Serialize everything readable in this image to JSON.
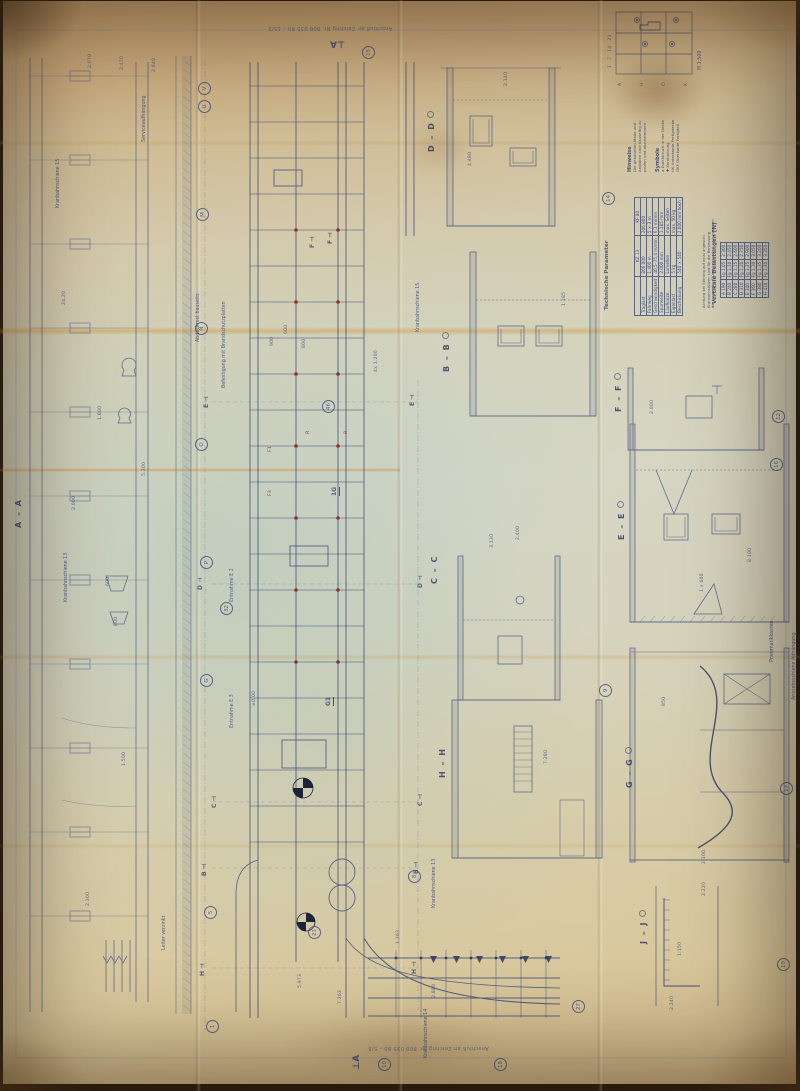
{
  "ink": "#44537c",
  "red": "#8e231a",
  "notes": {
    "top": "Anschluß an Zeichng Nr. 800 035 80 – 15/2",
    "bottom": "Anschluß an Zeichng Nr. 800 035 80 – 5/8"
  },
  "sections": [
    {
      "t": "A – A",
      "x": 14,
      "y": 528
    },
    {
      "t": "D – D",
      "x": 427,
      "y": 152,
      "cls": "wc"
    },
    {
      "t": "B – B",
      "x": 442,
      "y": 372,
      "cls": "wc"
    },
    {
      "t": "C – C",
      "x": 430,
      "y": 584
    },
    {
      "t": "H – H",
      "x": 438,
      "y": 778
    },
    {
      "t": "F – F",
      "x": 614,
      "y": 412,
      "cls": "wc"
    },
    {
      "t": "E – E",
      "x": 617,
      "y": 540,
      "cls": "wc"
    },
    {
      "t": "G – G",
      "x": 625,
      "y": 788,
      "cls": "wc"
    },
    {
      "t": "J – J",
      "x": 639,
      "y": 944,
      "cls": "wc"
    }
  ],
  "cut_marks": [
    {
      "t": "⊥A",
      "x": 330,
      "y": 38,
      "cls": "r180 big"
    },
    {
      "t": "⊥A",
      "x": 352,
      "y": 1070,
      "cls": "big"
    },
    {
      "t": "F ⊣",
      "x": 310,
      "y": 248
    },
    {
      "t": "F ⊣",
      "x": 328,
      "y": 244
    },
    {
      "t": "E ⊣",
      "x": 204,
      "y": 408
    },
    {
      "t": "E ⊣",
      "x": 410,
      "y": 406
    },
    {
      "t": "D ⊣",
      "x": 198,
      "y": 590
    },
    {
      "t": "D ⊣",
      "x": 418,
      "y": 588
    },
    {
      "t": "C ⊣",
      "x": 212,
      "y": 808
    },
    {
      "t": "C ⊣",
      "x": 418,
      "y": 806
    },
    {
      "t": "B ⊣",
      "x": 202,
      "y": 876
    },
    {
      "t": "B ⊣",
      "x": 414,
      "y": 874
    },
    {
      "t": "H ⊣",
      "x": 200,
      "y": 976
    },
    {
      "t": "H ⊣",
      "x": 412,
      "y": 974
    },
    {
      "t": "1G",
      "x": 332,
      "y": 496,
      "cls": "ul"
    },
    {
      "t": "G1",
      "x": 326,
      "y": 706,
      "cls": "ul"
    }
  ],
  "bubbles": [
    {
      "t": "V",
      "x": 198,
      "y": 82
    },
    {
      "t": "U",
      "x": 198,
      "y": 100
    },
    {
      "t": "M",
      "x": 196,
      "y": 208
    },
    {
      "t": "N",
      "x": 195,
      "y": 322
    },
    {
      "t": "O",
      "x": 195,
      "y": 438
    },
    {
      "t": "P",
      "x": 200,
      "y": 556
    },
    {
      "t": "G",
      "x": 200,
      "y": 674
    },
    {
      "t": "32",
      "x": 220,
      "y": 602
    },
    {
      "t": "46",
      "x": 322,
      "y": 400
    },
    {
      "t": "15",
      "x": 362,
      "y": 46
    },
    {
      "t": "21",
      "x": 308,
      "y": 926
    },
    {
      "t": "5",
      "x": 204,
      "y": 906
    },
    {
      "t": "1",
      "x": 206,
      "y": 1020
    },
    {
      "t": "8",
      "x": 408,
      "y": 870
    },
    {
      "t": "10",
      "x": 378,
      "y": 1058
    },
    {
      "t": "18",
      "x": 494,
      "y": 1058
    },
    {
      "t": "14",
      "x": 602,
      "y": 192
    },
    {
      "t": "12",
      "x": 772,
      "y": 410
    },
    {
      "t": "16",
      "x": 770,
      "y": 458
    },
    {
      "t": "9",
      "x": 599,
      "y": 684
    },
    {
      "t": "17",
      "x": 780,
      "y": 782
    },
    {
      "t": "19",
      "x": 777,
      "y": 958
    },
    {
      "t": "27",
      "x": 572,
      "y": 1000
    }
  ],
  "dims": [
    {
      "t": "2.070",
      "x": 88,
      "y": 68
    },
    {
      "t": "2.470",
      "x": 120,
      "y": 70
    },
    {
      "t": "2.640",
      "x": 152,
      "y": 72
    },
    {
      "t": "24,20",
      "x": 62,
      "y": 305
    },
    {
      "t": "1.800",
      "x": 98,
      "y": 420
    },
    {
      "t": "2.000",
      "x": 72,
      "y": 510
    },
    {
      "t": "5.300",
      "x": 142,
      "y": 476
    },
    {
      "t": "600",
      "x": 106,
      "y": 586
    },
    {
      "t": "800",
      "x": 114,
      "y": 626
    },
    {
      "t": "1.500",
      "x": 122,
      "y": 766
    },
    {
      "t": "2.300",
      "x": 86,
      "y": 906
    },
    {
      "t": "600",
      "x": 284,
      "y": 334
    },
    {
      "t": "900",
      "x": 270,
      "y": 346
    },
    {
      "t": "800",
      "x": 302,
      "y": 348
    },
    {
      "t": "4x 1.200",
      "x": 374,
      "y": 372
    },
    {
      "t": "±0,00",
      "x": 252,
      "y": 706
    },
    {
      "t": "5.973",
      "x": 298,
      "y": 988
    },
    {
      "t": "7.262",
      "x": 338,
      "y": 1004
    },
    {
      "t": "2.880",
      "x": 432,
      "y": 998
    },
    {
      "t": "1.363",
      "x": 396,
      "y": 944
    },
    {
      "t": "2.140",
      "x": 504,
      "y": 86
    },
    {
      "t": "4.480",
      "x": 468,
      "y": 166
    },
    {
      "t": "2.400",
      "x": 516,
      "y": 540
    },
    {
      "t": "3.130",
      "x": 490,
      "y": 548
    },
    {
      "t": "7.280",
      "x": 544,
      "y": 764
    },
    {
      "t": "1.185",
      "x": 562,
      "y": 306
    },
    {
      "t": "2.000",
      "x": 650,
      "y": 414
    },
    {
      "t": "1 x 600",
      "x": 700,
      "y": 592
    },
    {
      "t": "8.100",
      "x": 748,
      "y": 562
    },
    {
      "t": "850",
      "x": 662,
      "y": 706
    },
    {
      "t": "2.100",
      "x": 702,
      "y": 864
    },
    {
      "t": "2.220",
      "x": 702,
      "y": 896
    },
    {
      "t": "2.240",
      "x": 670,
      "y": 1010
    },
    {
      "t": "1:150",
      "x": 678,
      "y": 956
    }
  ],
  "annotations": [
    {
      "t": "Kranbahnschiene 15",
      "x": 56,
      "y": 208
    },
    {
      "t": "Serviceaufhängung",
      "x": 142,
      "y": 142
    },
    {
      "t": "Kranbahnschiene 13",
      "x": 64,
      "y": 602
    },
    {
      "t": "Kranbahnschiene 15.",
      "x": 416,
      "y": 332
    },
    {
      "t": "Kranbahnschiene 13",
      "x": 432,
      "y": 908
    },
    {
      "t": "Entnahme E 2",
      "x": 230,
      "y": 602
    },
    {
      "t": "Entnahme E 3",
      "x": 230,
      "y": 728
    },
    {
      "t": "Abdeckrost bauseits",
      "x": 196,
      "y": 342
    },
    {
      "t": "Befestigung mit Brandschutzplatten",
      "x": 222,
      "y": 388
    },
    {
      "t": "Leiter verzinkt",
      "x": 162,
      "y": 950
    },
    {
      "t": "Pneumatikkasten",
      "x": 770,
      "y": 662
    },
    {
      "t": "Antriebsschiene Abhängung",
      "x": 792,
      "y": 700
    },
    {
      "t": "Kranbahnschiene 14",
      "x": 424,
      "y": 1058
    },
    {
      "t": "M 1:500",
      "x": 698,
      "y": 70
    }
  ],
  "red_marks": [
    {
      "t": "R",
      "x": 306,
      "y": 434
    },
    {
      "t": "R",
      "x": 344,
      "y": 434
    },
    {
      "t": "F1",
      "x": 268,
      "y": 452
    },
    {
      "t": "F3",
      "x": 268,
      "y": 496
    }
  ],
  "key_plan": {
    "numbers": "1   7   14   21",
    "letters": [
      {
        "t": "A",
        "x": 618,
        "y": 86
      },
      {
        "t": "H",
        "x": 640,
        "y": 86
      },
      {
        "t": "O",
        "x": 662,
        "y": 86
      },
      {
        "t": "K",
        "x": 684,
        "y": 86
      }
    ]
  },
  "legend": {
    "hinweise": {
      "title": "Hinweise",
      "lines": [
        "Die genannten Maße und",
        "Angaben sind bauseitig zu",
        "prüfen und abzustimmen"
      ]
    },
    "symbole": {
      "title": "Symbole",
      "items": [
        "⌀  Durchbruch in der Decke",
        "✚  Kernbohrung",
        "UK  Unterkante Fertigdecke",
        "OKF  Oberkante Fertigteil"
      ]
    }
  },
  "parameter_table": {
    "title": "Technische Parameter",
    "columns": [
      "",
      "KZ 13",
      "KF 80"
    ],
    "rows": [
      [
        "Traglast",
        "866 000",
        "206 800"
      ],
      [
        "Fahrweg",
        "1.400 m",
        "5 × 3 m"
      ],
      [
        "Geschwindigkeit",
        "40,5–75,4 m/min",
        "6,3 m/min"
      ],
      [
        "Spurweite",
        "2.000 mm",
        "1.185 mm"
      ],
      [
        "Laufkatze",
        "Lamellen",
        "max. Seiten"
      ],
      [
        "Eigenlast",
        "5 kg",
        "max. 50 kg"
      ],
      [
        "Beschickung",
        "540 × 540",
        "2.000 mm hoch"
      ]
    ]
  },
  "load_table": {
    "title": "Vertikale Belastungen [N]",
    "note_lines": [
      "Achtung bei Störung auf axial angeschl.",
      "Kranbahnstützen sind für die Bemessung",
      "der tragenden Stützen gesondert nachzuweisen"
    ],
    "rows": [
      [
        "A 190",
        "Fg 1,05",
        "2.300"
      ],
      [
        "B 240",
        "Fg 1,10",
        "2.450"
      ],
      [
        "C 280",
        "Fg 1,15",
        "2.600"
      ],
      [
        "D 310",
        "Fg 1,20",
        "2.750"
      ],
      [
        "E 340",
        "Fg 1,25",
        "2.900"
      ],
      [
        "F 360",
        "Fg 1,30",
        "3.050"
      ],
      [
        "G 380",
        "Fg 1,35",
        "3.200"
      ],
      [
        "H 410",
        "Fg 1,40",
        "3.350"
      ]
    ]
  }
}
